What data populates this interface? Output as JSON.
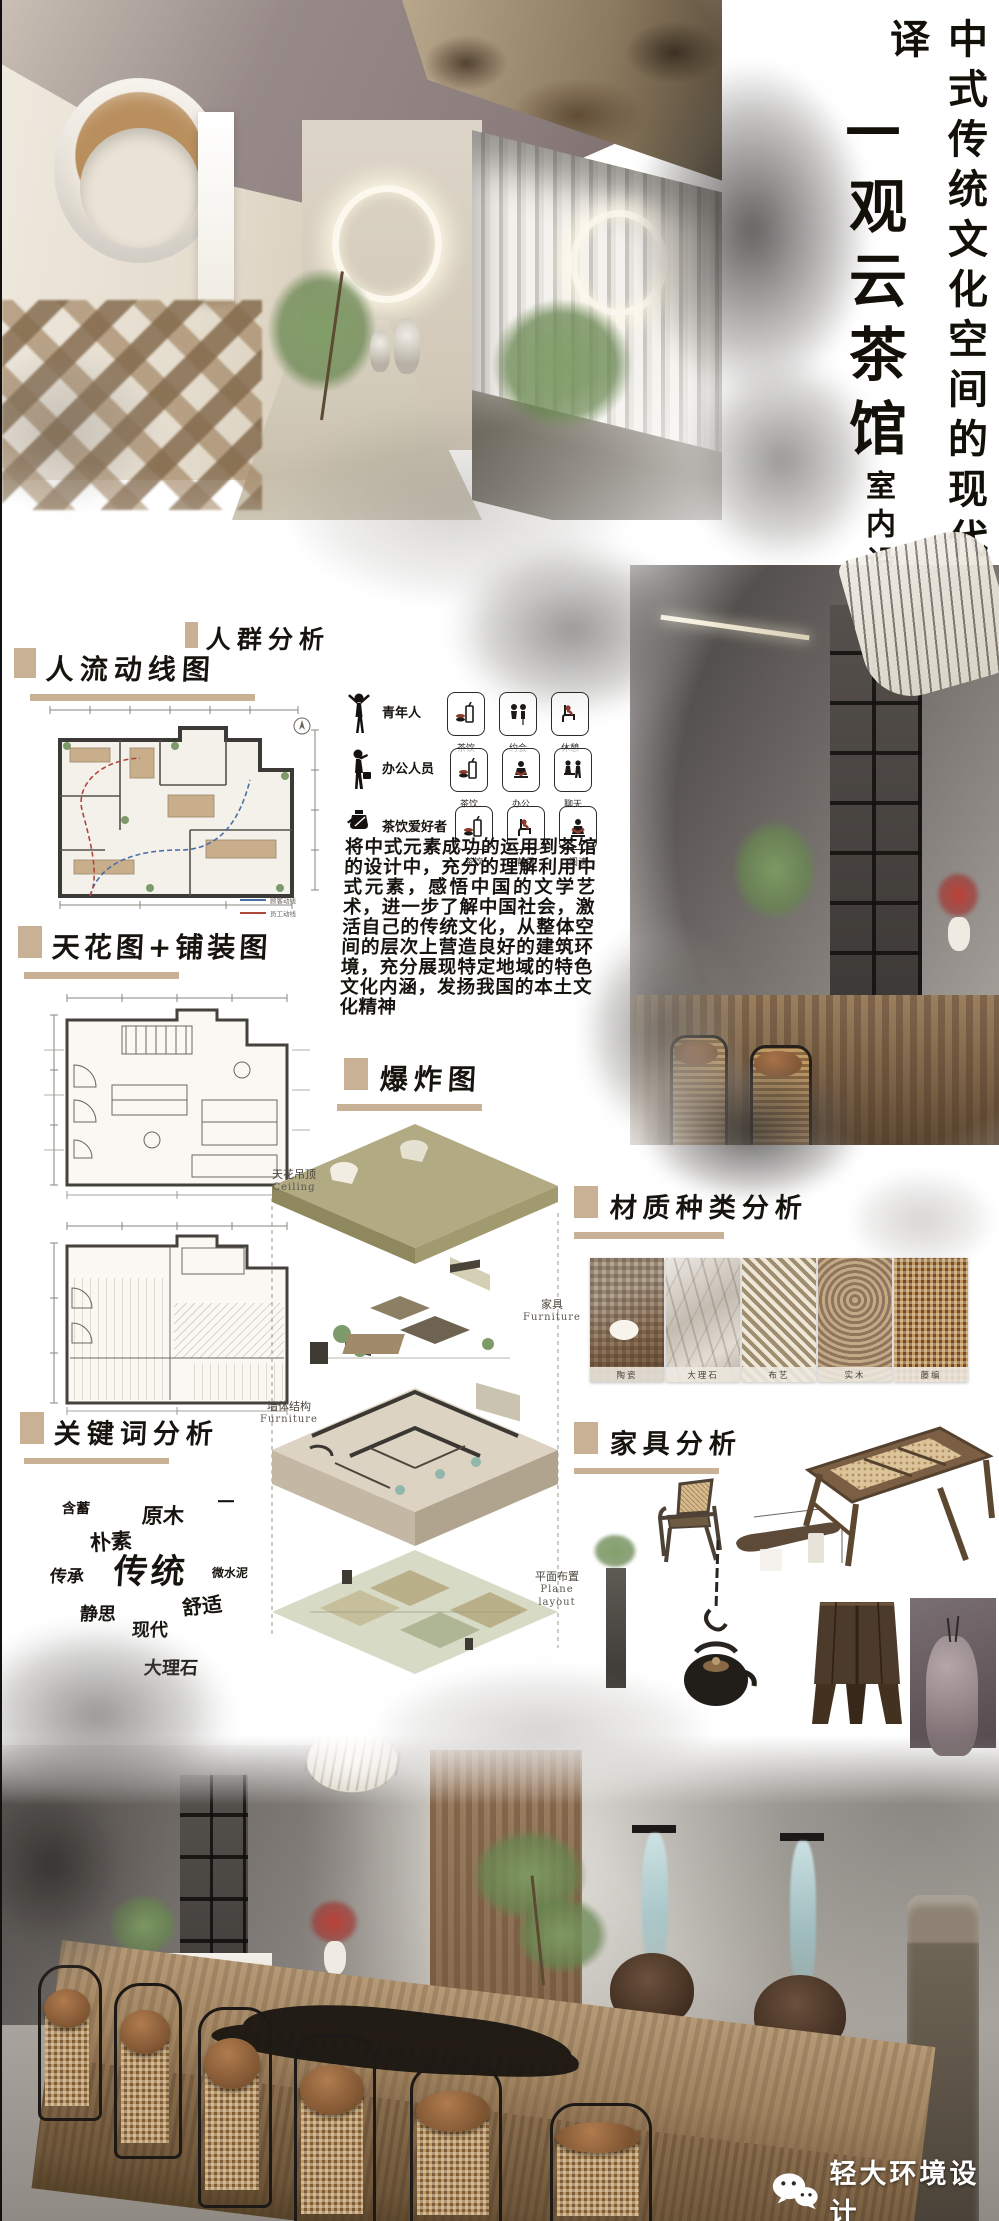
{
  "poster": {
    "title_main": "中式传统文化空间的现代转译",
    "title_house": "—观云茶馆",
    "title_sub": "室内设计",
    "accent_color": "#c9b195",
    "ink_color": "#17140f"
  },
  "sections": {
    "flow": {
      "title": "人流动线图",
      "legend": [
        {
          "label": "顾客动线",
          "color": "#4a6fa5"
        },
        {
          "label": "员工动线",
          "color": "#b0483f"
        }
      ]
    },
    "crowd": {
      "title": "人群分析",
      "groups": [
        {
          "name": "青年人",
          "tags": [
            "茶饮",
            "约会",
            "休憩"
          ]
        },
        {
          "name": "办公人员",
          "tags": [
            "茶饮",
            "办公",
            "聊天"
          ]
        },
        {
          "name": "茶饮爱好者",
          "tags": [
            "茶饮",
            "静思",
            "阅读"
          ]
        }
      ]
    },
    "concept_text": "将中式元素成功的运用到茶馆的设计中，充分的理解利用中式元素，感悟中国的文学艺术，进一步了解中国社会，激活自己的传统文化，从整体空间的层次上营造良好的建筑环境，充分展现特定地域的特色文化内涵，发扬我国的本土文化精神",
    "ceilpave": {
      "title": "天花图+铺装图"
    },
    "explode": {
      "title": "爆炸图",
      "layers": [
        {
          "zh": "天花吊顶",
          "en": "Ceiling"
        },
        {
          "zh": "家具",
          "en": "Furniture"
        },
        {
          "zh": "墙体结构",
          "en": "Furniture"
        },
        {
          "zh": "平面布置",
          "en": "Plane layout"
        }
      ]
    },
    "materials": {
      "title": "材质种类分析",
      "items": [
        "陶瓷",
        "大理石",
        "布艺",
        "实木",
        "藤编"
      ]
    },
    "keywords": {
      "title": "关键词分析",
      "words": [
        "含蓄",
        "原木",
        "—",
        "朴素",
        "传承",
        "传统",
        "微水泥",
        "静思",
        "舒适",
        "现代",
        "大理石"
      ]
    },
    "furniture": {
      "title": "家具分析"
    }
  },
  "footer": {
    "brand": "轻大环境设计"
  }
}
